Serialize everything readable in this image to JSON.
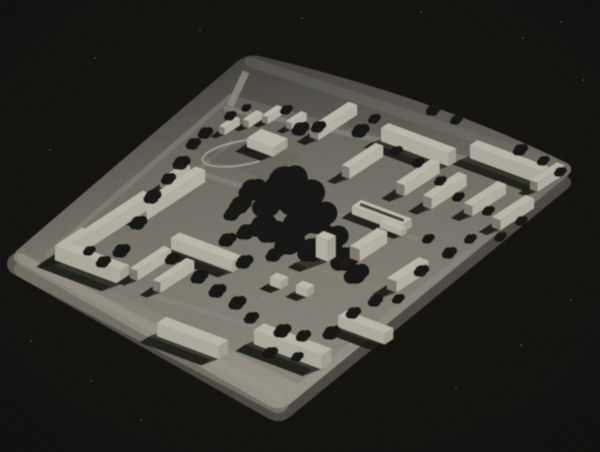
{
  "meta": {
    "description": "Black-and-white aerial-oblique photograph of an architectural scale model of a modernist housing estate: a light rounded-corner baseboard on a black background, white rectangular slab buildings, dark irregular tree masses, a running-track oval and a street grid.",
    "image_type": "photograph-of-physical-model",
    "width": 600,
    "height": 452
  },
  "palette": {
    "background": "#0b0a07",
    "board_side": "#53504a",
    "board_gradient": [
      [
        0,
        "#474540"
      ],
      [
        0.28,
        "#6d6a61"
      ],
      [
        0.58,
        "#918d81"
      ],
      [
        0.84,
        "#aba698"
      ],
      [
        1,
        "#b5b0a2"
      ],
      [
        "axis",
        247,
        53,
        280,
        412
      ]
    ],
    "district_fill": "#8a867b",
    "road": "#a29d91",
    "margin_road": "#b2ada0",
    "oval_stroke": "#b6b2a5",
    "oval_field": "#6b6860",
    "building_top": "#dcd8c9",
    "building_front_v": "#cdc9ba",
    "building_end_v": "#bdb9aa",
    "building_front_u": "#d2cebf",
    "building_end_u": "#8e8a7e",
    "shadow": "#14120e",
    "tree": "#0b0a07",
    "dust": "#e8e4d8"
  },
  "scene": {
    "background": "#0b0a07",
    "axes": {
      "u": [
        0.84,
        -0.55
      ],
      "v": [
        0.937,
        0.35
      ]
    },
    "board": {
      "corners": [
        [
          247,
          53
        ],
        [
          577,
          168
        ],
        [
          280,
          412
        ],
        [
          8,
          258
        ]
      ],
      "path": "M236.4,62.1 Q247,53 260.6,56.2 Q430,96 564.4,161.8 Q577,168 566.2,176.9 L290.8,403.1 Q280,412 267.8,405.1 L20.2,264.9 Q8,258 18.6,248.9 Z",
      "side_offset": 13
    },
    "district": {
      "points": [
        [
          234,
          96
        ],
        [
          552,
          182
        ],
        [
          298,
          384
        ],
        [
          44,
          256
        ]
      ],
      "opacity": 0.45
    },
    "margin_strips": [
      {
        "pts": [
          [
            18,
            264
          ],
          [
            278,
            402
          ]
        ],
        "w": 22,
        "color": "#aba698",
        "opacity": 0.55
      },
      {
        "pts": [
          [
            22,
            258
          ],
          [
            280,
            396
          ]
        ],
        "w": 9,
        "color": "#b8b3a5",
        "opacity": 0.5
      },
      {
        "pts": [
          [
            250,
            62
          ],
          [
            566,
            168
          ]
        ],
        "w": 10,
        "color": "#8f8b80",
        "opacity": 0.3
      }
    ],
    "sports_patch": {
      "points": [
        [
          186,
          148
        ],
        [
          266,
          180
        ],
        [
          300,
          157
        ],
        [
          220,
          124
        ]
      ],
      "opacity": 0.5
    },
    "oval": {
      "cx": 242,
      "cy": 153,
      "rx": 40,
      "ry": 12,
      "rotation": -10
    },
    "entrance_road": {
      "pts": [
        [
          246,
          72
        ],
        [
          230,
          106
        ]
      ],
      "w": 7
    },
    "roads": [
      {
        "pts": [
          [
            224,
            108
          ],
          [
            560,
            178
          ]
        ],
        "w": 5,
        "opacity": 0.6
      },
      {
        "pts": [
          [
            46,
            256
          ],
          [
            232,
            95
          ]
        ],
        "w": 5,
        "opacity": 0.55
      },
      {
        "pts": [
          [
            148,
            211
          ],
          [
            233,
            141
          ]
        ],
        "w": 4,
        "opacity": 0.45
      },
      {
        "pts": [
          [
            186,
            168
          ],
          [
            430,
            243
          ]
        ],
        "w": 4,
        "opacity": 0.4
      },
      {
        "pts": [
          [
            140,
            292
          ],
          [
            345,
            354
          ]
        ],
        "w": 5,
        "opacity": 0.55
      },
      {
        "pts": [
          [
            345,
            354
          ],
          [
            470,
            250
          ]
        ],
        "w": 4,
        "opacity": 0.45
      },
      {
        "pts": [
          [
            258,
            302
          ],
          [
            348,
            228
          ]
        ],
        "w": 4,
        "opacity": 0.35
      },
      {
        "pts": [
          [
            300,
            264
          ],
          [
            388,
            291
          ]
        ],
        "w": 3,
        "opacity": 0.35
      },
      {
        "pts": [
          [
            190,
            171
          ],
          [
            245,
            188
          ]
        ],
        "w": 4,
        "opacity": 0.4
      }
    ],
    "buildings": [
      {
        "x": 219,
        "y": 133,
        "dir": "u",
        "len": 18,
        "wid": 6,
        "h": 7
      },
      {
        "x": 243,
        "y": 126,
        "dir": "u",
        "len": 16,
        "wid": 6,
        "h": 7
      },
      {
        "x": 247,
        "y": 147,
        "dir": "v",
        "len": 28,
        "wid": 17,
        "h": 9
      },
      {
        "x": 262,
        "y": 122,
        "dir": "u",
        "len": 18,
        "wid": 6,
        "h": 7
      },
      {
        "x": 286,
        "y": 128,
        "dir": "u",
        "len": 18,
        "wid": 6,
        "h": 7
      },
      {
        "x": 310,
        "y": 137,
        "dir": "u",
        "len": 46,
        "wid": 9,
        "h": 10
      },
      {
        "x": 381,
        "y": 141,
        "dir": "v",
        "len": 72,
        "wid": 9,
        "h": 13
      },
      {
        "x": 470,
        "y": 158,
        "dir": "v",
        "len": 76,
        "wid": 9,
        "h": 13
      },
      {
        "x": 396,
        "y": 193,
        "dir": "u",
        "len": 42,
        "wid": 9,
        "h": 11
      },
      {
        "x": 423,
        "y": 206,
        "dir": "u",
        "len": 42,
        "wid": 9,
        "h": 11
      },
      {
        "x": 464,
        "y": 213,
        "dir": "u",
        "len": 40,
        "wid": 9,
        "h": 10
      },
      {
        "x": 492,
        "y": 227,
        "dir": "u",
        "len": 40,
        "wid": 9,
        "h": 10
      },
      {
        "x": 530,
        "y": 189,
        "dir": "u",
        "len": 32,
        "wid": 8,
        "h": 9
      },
      {
        "x": 342,
        "y": 176,
        "dir": "u",
        "len": 40,
        "wid": 8,
        "h": 11
      },
      {
        "x": 352,
        "y": 214,
        "dir": "v",
        "len": 54,
        "wid": 11,
        "h": 8,
        "roof_stripe": true
      },
      {
        "x": 380,
        "y": 228,
        "dir": "v",
        "len": 23,
        "wid": 6,
        "h": 6
      },
      {
        "x": 316,
        "y": 257,
        "dir": "v",
        "len": 13,
        "wid": 9,
        "h": 21
      },
      {
        "x": 350,
        "y": 258,
        "dir": "u",
        "len": 33,
        "wid": 10,
        "h": 12
      },
      {
        "x": 72,
        "y": 250,
        "dir": "u",
        "len": 84,
        "wid": 10,
        "h": 13
      },
      {
        "x": 137,
        "y": 217,
        "dir": "u",
        "len": 70,
        "wid": 10,
        "h": 12
      },
      {
        "x": 160,
        "y": 187,
        "dir": "u",
        "len": 28,
        "wid": 7,
        "h": 8
      },
      {
        "x": 55,
        "y": 260,
        "dir": "v",
        "len": 70,
        "wid": 10,
        "h": 14
      },
      {
        "x": 57,
        "y": 258,
        "dir": "u",
        "len": 30,
        "wid": 9,
        "h": 14
      },
      {
        "x": 130,
        "y": 278,
        "dir": "u",
        "len": 40,
        "wid": 8,
        "h": 10
      },
      {
        "x": 153,
        "y": 290,
        "dir": "u",
        "len": 40,
        "wid": 8,
        "h": 10
      },
      {
        "x": 171,
        "y": 249,
        "dir": "v",
        "len": 66,
        "wid": 10,
        "h": 11
      },
      {
        "x": 157,
        "y": 336,
        "dir": "v",
        "len": 66,
        "wid": 11,
        "h": 13
      },
      {
        "x": 254,
        "y": 344,
        "dir": "v",
        "len": 72,
        "wid": 12,
        "h": 14
      },
      {
        "x": 338,
        "y": 327,
        "dir": "v",
        "len": 50,
        "wid": 10,
        "h": 11
      },
      {
        "x": 387,
        "y": 289,
        "dir": "u",
        "len": 38,
        "wid": 10,
        "h": 11
      },
      {
        "x": 270,
        "y": 285,
        "dir": "v",
        "len": 12,
        "wid": 8,
        "h": 8
      },
      {
        "x": 296,
        "y": 293,
        "dir": "v",
        "len": 12,
        "wid": 8,
        "h": 8
      }
    ],
    "park_blobs": [
      [
        285,
        183,
        17
      ],
      [
        301,
        198,
        18
      ],
      [
        316,
        218,
        16
      ],
      [
        296,
        226,
        14
      ],
      [
        330,
        240,
        14
      ],
      [
        268,
        204,
        13
      ],
      [
        345,
        259,
        12
      ],
      [
        312,
        250,
        12
      ],
      [
        356,
        274,
        10
      ],
      [
        252,
        190,
        11
      ],
      [
        262,
        226,
        11
      ],
      [
        240,
        205,
        9
      ],
      [
        289,
        243,
        12
      ],
      [
        271,
        232,
        11
      ]
    ],
    "trees": [
      [
        300,
        129,
        7
      ],
      [
        318,
        127,
        6
      ],
      [
        360,
        131,
        7
      ],
      [
        374,
        119,
        5
      ],
      [
        433,
        110,
        6
      ],
      [
        456,
        120,
        5
      ],
      [
        286,
        110,
        5
      ],
      [
        520,
        150,
        6
      ],
      [
        543,
        161,
        5
      ],
      [
        560,
        172,
        5
      ],
      [
        205,
        133,
        6
      ],
      [
        193,
        144,
        6
      ],
      [
        181,
        163,
        7
      ],
      [
        168,
        179,
        6
      ],
      [
        152,
        197,
        7
      ],
      [
        138,
        223,
        7
      ],
      [
        121,
        251,
        7
      ],
      [
        103,
        262,
        6
      ],
      [
        89,
        251,
        5
      ],
      [
        172,
        259,
        6
      ],
      [
        199,
        277,
        7
      ],
      [
        217,
        291,
        7
      ],
      [
        237,
        303,
        7
      ],
      [
        251,
        318,
        6
      ],
      [
        282,
        331,
        7
      ],
      [
        303,
        336,
        6
      ],
      [
        331,
        333,
        7
      ],
      [
        353,
        313,
        6
      ],
      [
        375,
        301,
        6
      ],
      [
        398,
        299,
        5
      ],
      [
        270,
        353,
        6
      ],
      [
        297,
        357,
        5
      ],
      [
        421,
        271,
        6
      ],
      [
        449,
        253,
        6
      ],
      [
        470,
        239,
        5
      ],
      [
        428,
        239,
        5
      ],
      [
        500,
        237,
        5
      ],
      [
        521,
        221,
        5
      ],
      [
        488,
        211,
        5
      ],
      [
        458,
        197,
        5
      ],
      [
        440,
        181,
        5
      ],
      [
        418,
        163,
        5
      ],
      [
        396,
        151,
        5
      ],
      [
        230,
        116,
        5
      ],
      [
        246,
        108,
        4
      ],
      [
        274,
        255,
        7
      ],
      [
        246,
        232,
        8
      ],
      [
        232,
        214,
        7
      ],
      [
        244,
        262,
        7
      ],
      [
        227,
        240,
        7
      ]
    ],
    "dust": [
      [
        95,
        58
      ],
      [
        302,
        18
      ],
      [
        523,
        38
      ],
      [
        561,
        22
      ],
      [
        421,
        12
      ],
      [
        50,
        150
      ],
      [
        571,
        300
      ],
      [
        521,
        345
      ],
      [
        456,
        388
      ],
      [
        141,
        420
      ],
      [
        91,
        381
      ],
      [
        31,
        341
      ],
      [
        583,
        80
      ],
      [
        200,
        30
      ]
    ]
  }
}
